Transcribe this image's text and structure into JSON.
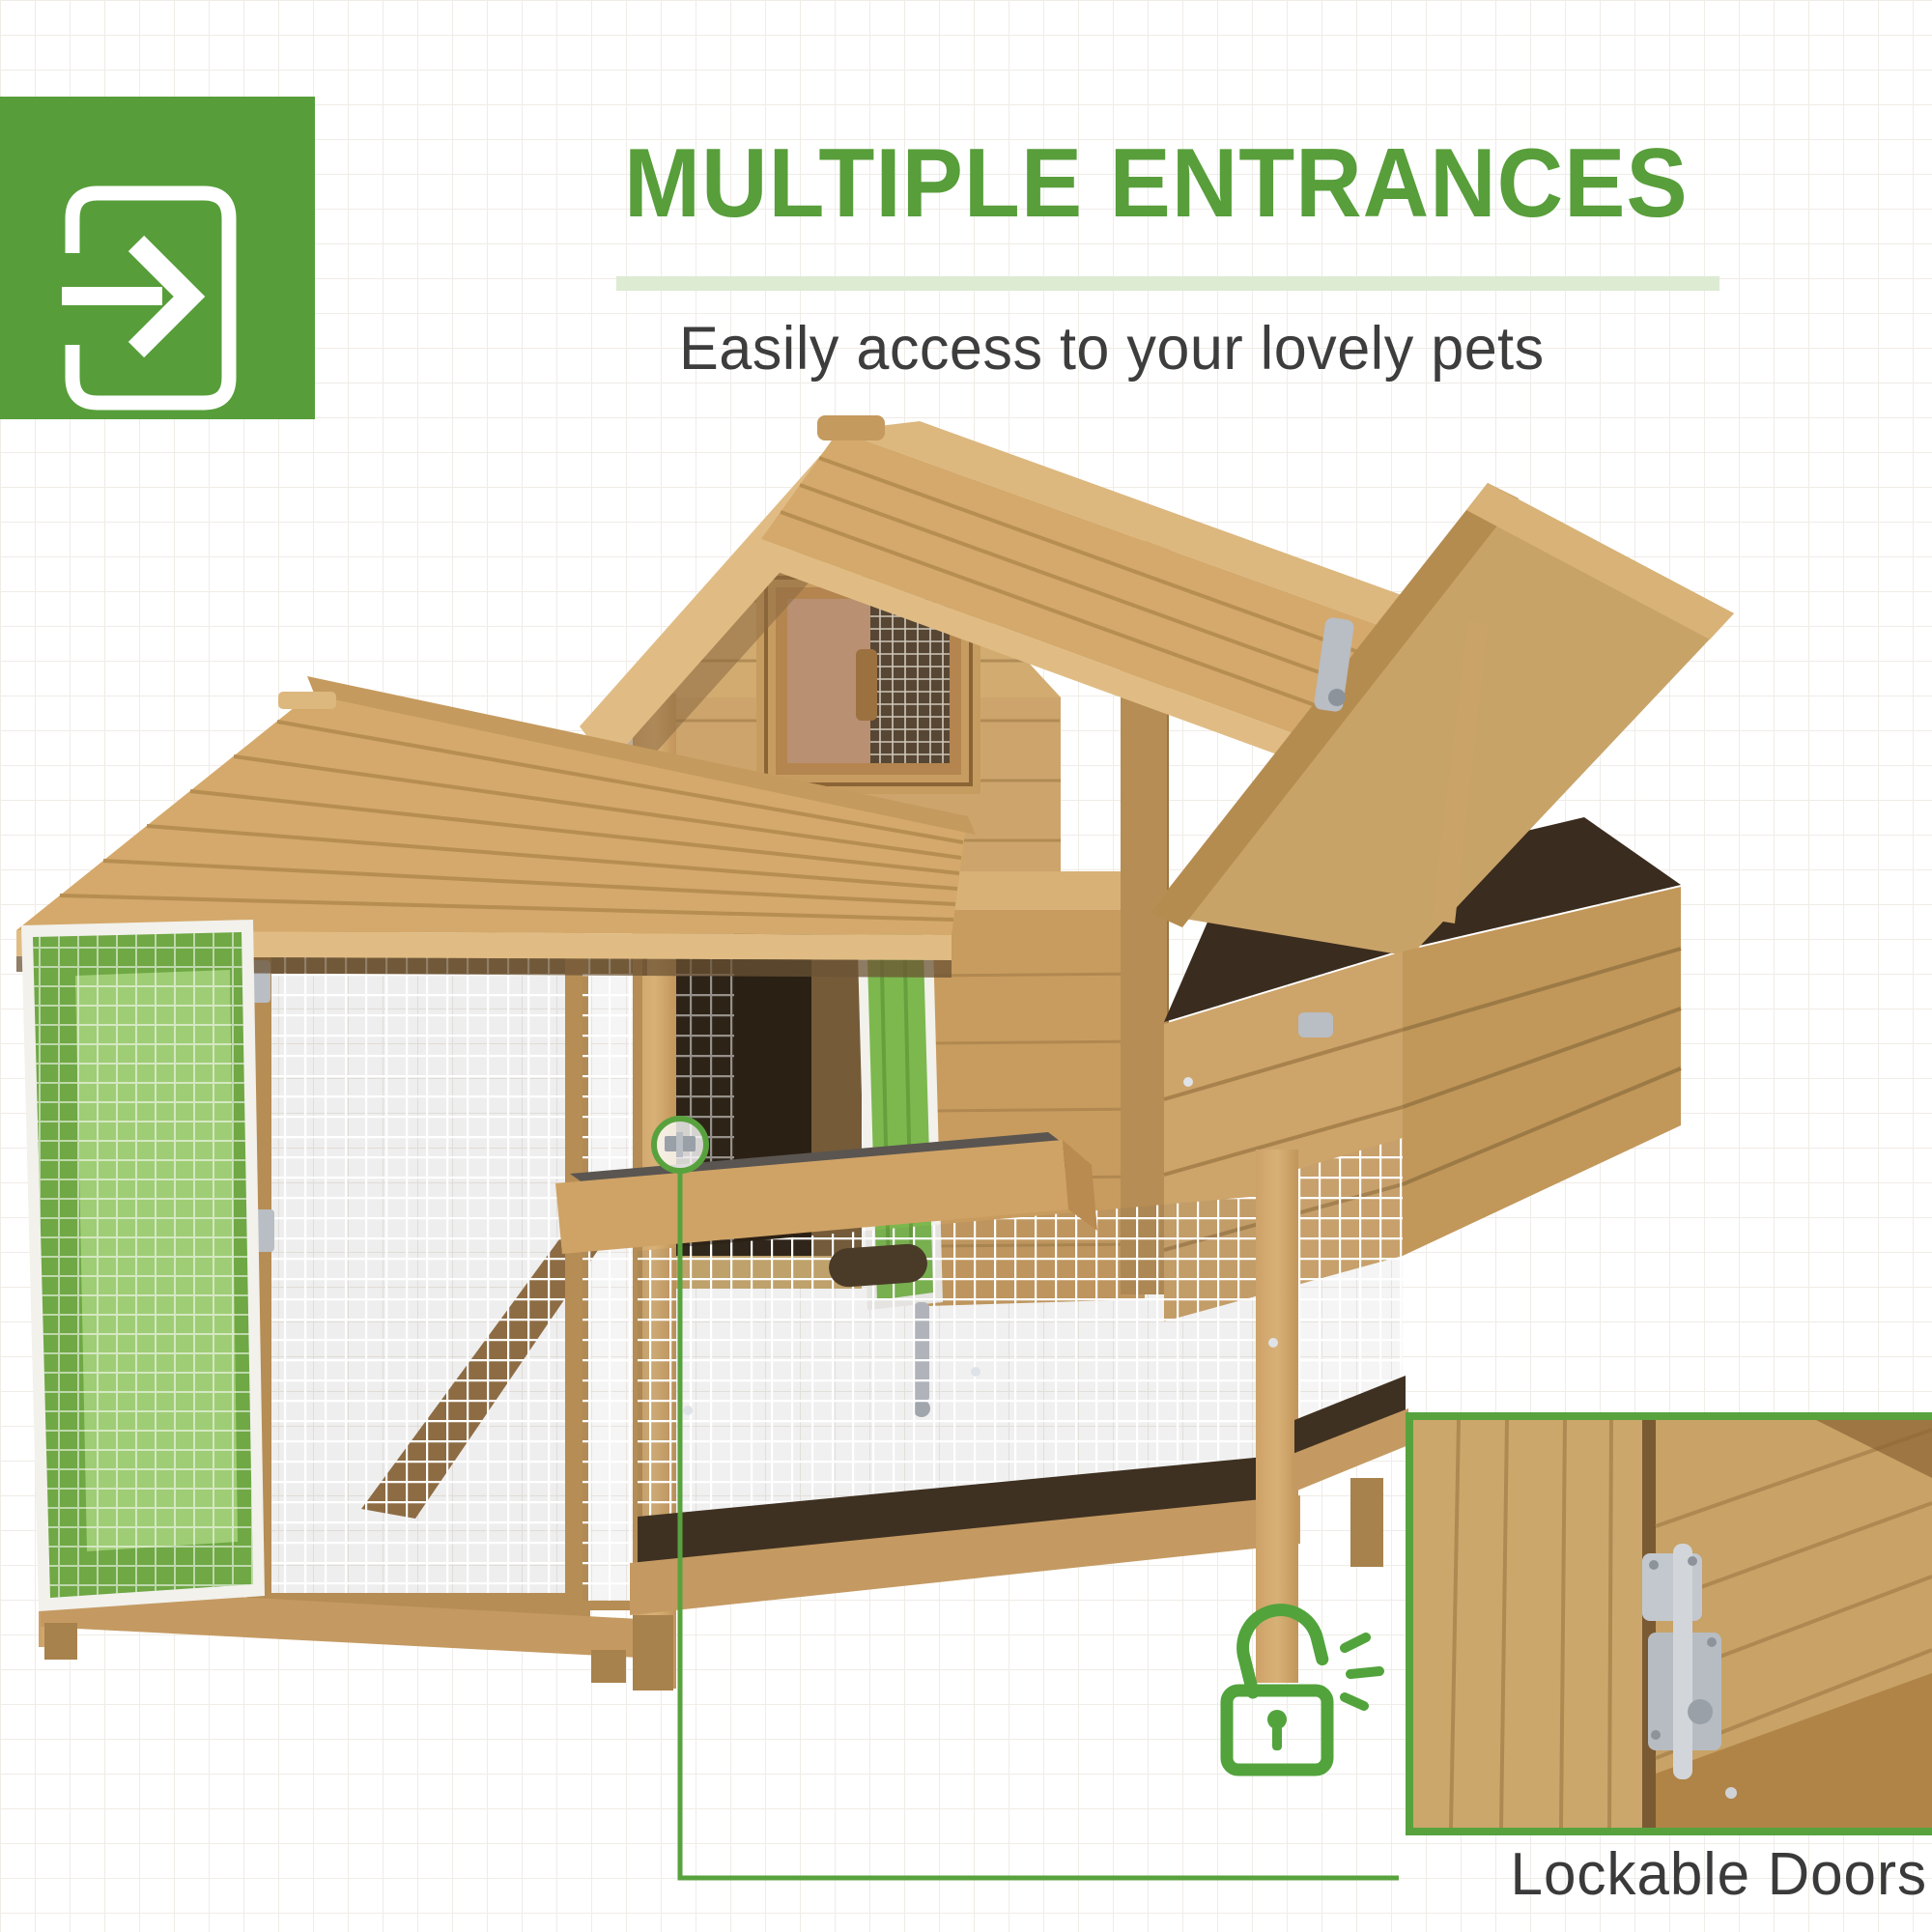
{
  "header": {
    "icon_block": {
      "bg_color": "#579e3a",
      "icon": "enter-door-arrow-icon"
    },
    "title": "MULTIPLE ENTRANCES",
    "title_color": "#589e3b",
    "underline_color": "#dcebd2",
    "subtitle": "Easily access to your lovely pets",
    "subtitle_color": "#3d3d3d"
  },
  "illustration": {
    "subject": "wooden chicken coop with side run, open nesting box lid and highlighted green doors",
    "highlight_green": "#7cb84e",
    "wood_light": "#d4ab72",
    "wood_mid": "#c79c61",
    "wood_dark": "#a8824c"
  },
  "callout": {
    "caption": "Lockable Doors",
    "line_color": "#58a23e",
    "marker": "latch-circle-marker",
    "lock_icon": "open-padlock-icon",
    "lock_icon_color": "#52a33c"
  },
  "inset": {
    "border_color": "#58a23e",
    "content": "door-latch-closeup"
  }
}
